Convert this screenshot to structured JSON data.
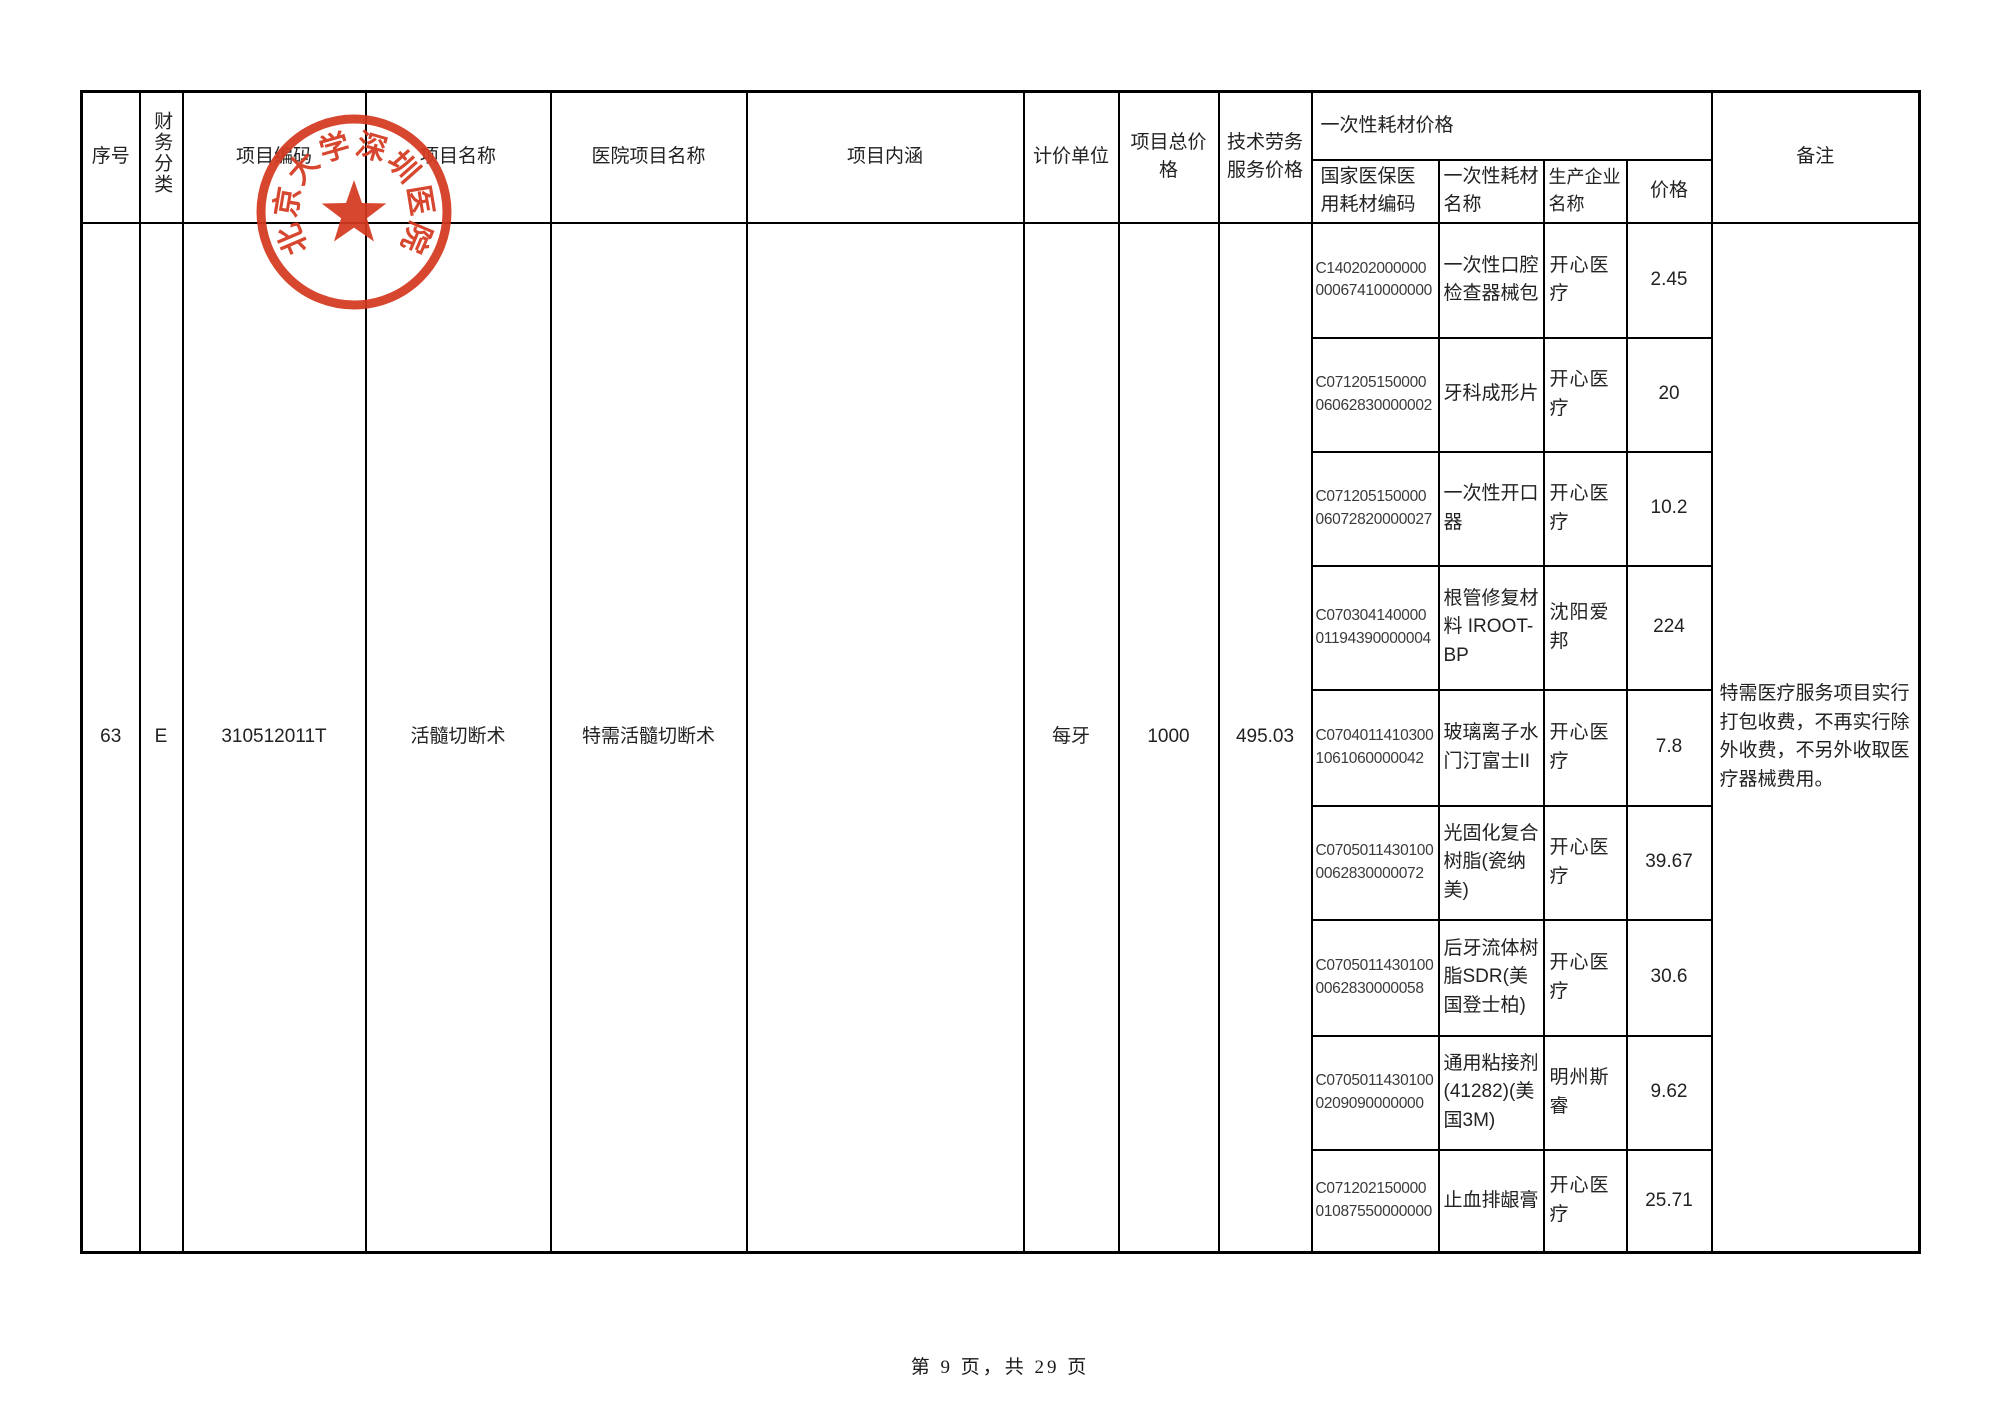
{
  "page": {
    "footer": "第 9 页，共 29 页",
    "stamp_text": "北京大学深圳医院",
    "stamp_color": "#d43a20"
  },
  "table": {
    "headers": {
      "index": "序号",
      "finance_class": "财务分类",
      "project_code": "项目编码",
      "project_name": "项目名称",
      "hospital_project_name": "医院项目名称",
      "project_content": "项目内涵",
      "unit": "计价单位",
      "total_price": "项目总价格",
      "tech_service_price": "技术劳务服务价格",
      "consumable_group": "一次性耗材价格",
      "consumable_code": "国家医保医用耗材编码",
      "consumable_name": "一次性耗材名称",
      "manufacturer": "生产企业名称",
      "price": "价格",
      "remark": "备注"
    },
    "row": {
      "index": "63",
      "finance_class": "E",
      "project_code": "310512011T",
      "project_name": "活髓切断术",
      "hospital_project_name": "特需活髓切断术",
      "project_content": "",
      "unit": "每牙",
      "total_price": "1000",
      "tech_service_price": "495.03",
      "remark": "特需医疗服务项目实行打包收费，不再实行除外收费，不另外收取医疗器械费用。"
    },
    "consumables": [
      {
        "code": "C14020200000000067410000000",
        "name": "一次性口腔检查器械包",
        "manufacturer": "开心医疗",
        "price": "2.45"
      },
      {
        "code": "C07120515000006062830000002",
        "name": "牙科成形片",
        "manufacturer": "开心医疗",
        "price": "20"
      },
      {
        "code": "C07120515000006072820000027",
        "name": "一次性开口器",
        "manufacturer": "开心医疗",
        "price": "10.2"
      },
      {
        "code": "C07030414000001194390000004",
        "name": "根管修复材料 IROOT-BP",
        "manufacturer": "沈阳爱邦",
        "price": "224"
      },
      {
        "code": "C07040114103001061060000042",
        "name": "玻璃离子水门汀富士II",
        "manufacturer": "开心医疗",
        "price": "7.8"
      },
      {
        "code": "C07050114301000062830000072",
        "name": "光固化复合树脂(瓷纳美)",
        "manufacturer": "开心医疗",
        "price": "39.67"
      },
      {
        "code": "C07050114301000062830000058",
        "name": "后牙流体树脂SDR(美国登士柏)",
        "manufacturer": "开心医疗",
        "price": "30.6"
      },
      {
        "code": "C07050114301000209090000000",
        "name": "通用粘接剂(41282)(美国3M)",
        "manufacturer": "明州斯睿",
        "price": "9.62"
      },
      {
        "code": "C07120215000001087550000000",
        "name": "止血排龈膏",
        "manufacturer": "开心医疗",
        "price": "25.71"
      }
    ]
  }
}
